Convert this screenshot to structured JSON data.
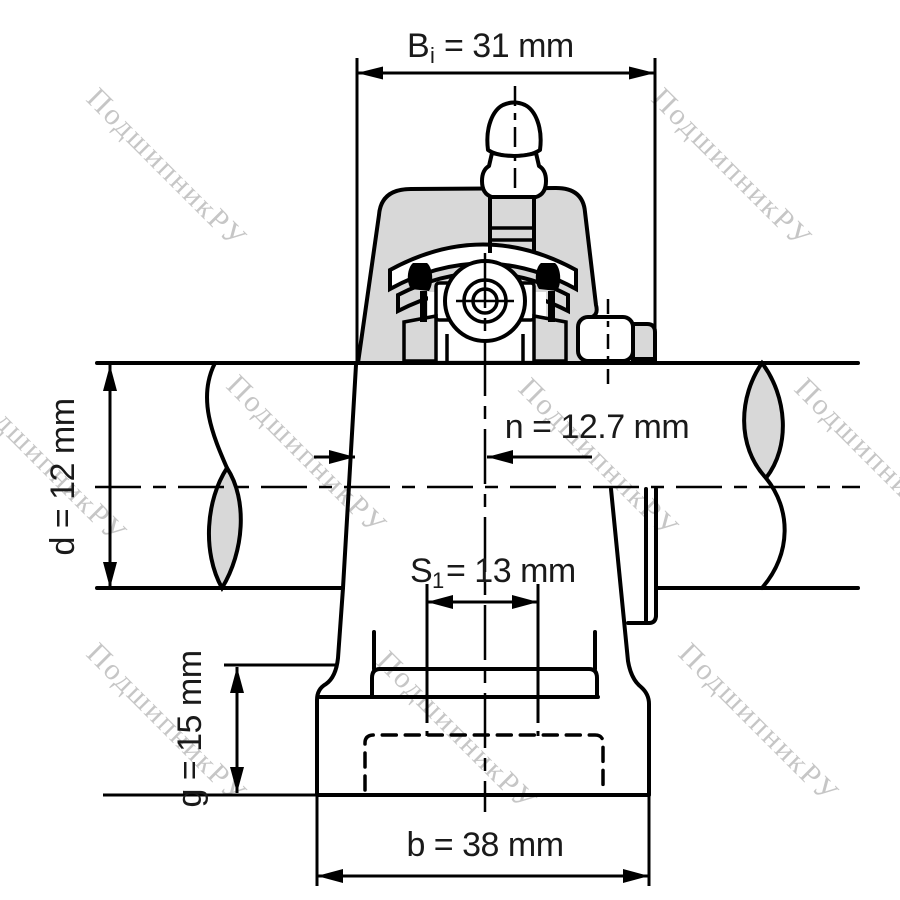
{
  "watermark": {
    "text": "ПодшипникРУ",
    "color": "#c6c6c6"
  },
  "colors": {
    "line": "#000000",
    "metal_fill": "#d8d8d8",
    "background": "#ffffff"
  },
  "dimensions": {
    "Bi": {
      "symbol": "B",
      "subscript": "i",
      "equals_value": "= 31 mm",
      "value_mm": 31
    },
    "d": {
      "label": "d = 12 mm",
      "value_mm": 12
    },
    "n": {
      "label": "n = 12.7 mm",
      "value_mm": 12.7
    },
    "S1": {
      "symbol": "S",
      "subscript": "1",
      "equals_value": "= 13 mm",
      "value_mm": 13
    },
    "g": {
      "label": "g = 15 mm",
      "value_mm": 15
    },
    "b": {
      "label": "b = 38 mm",
      "value_mm": 38
    }
  }
}
